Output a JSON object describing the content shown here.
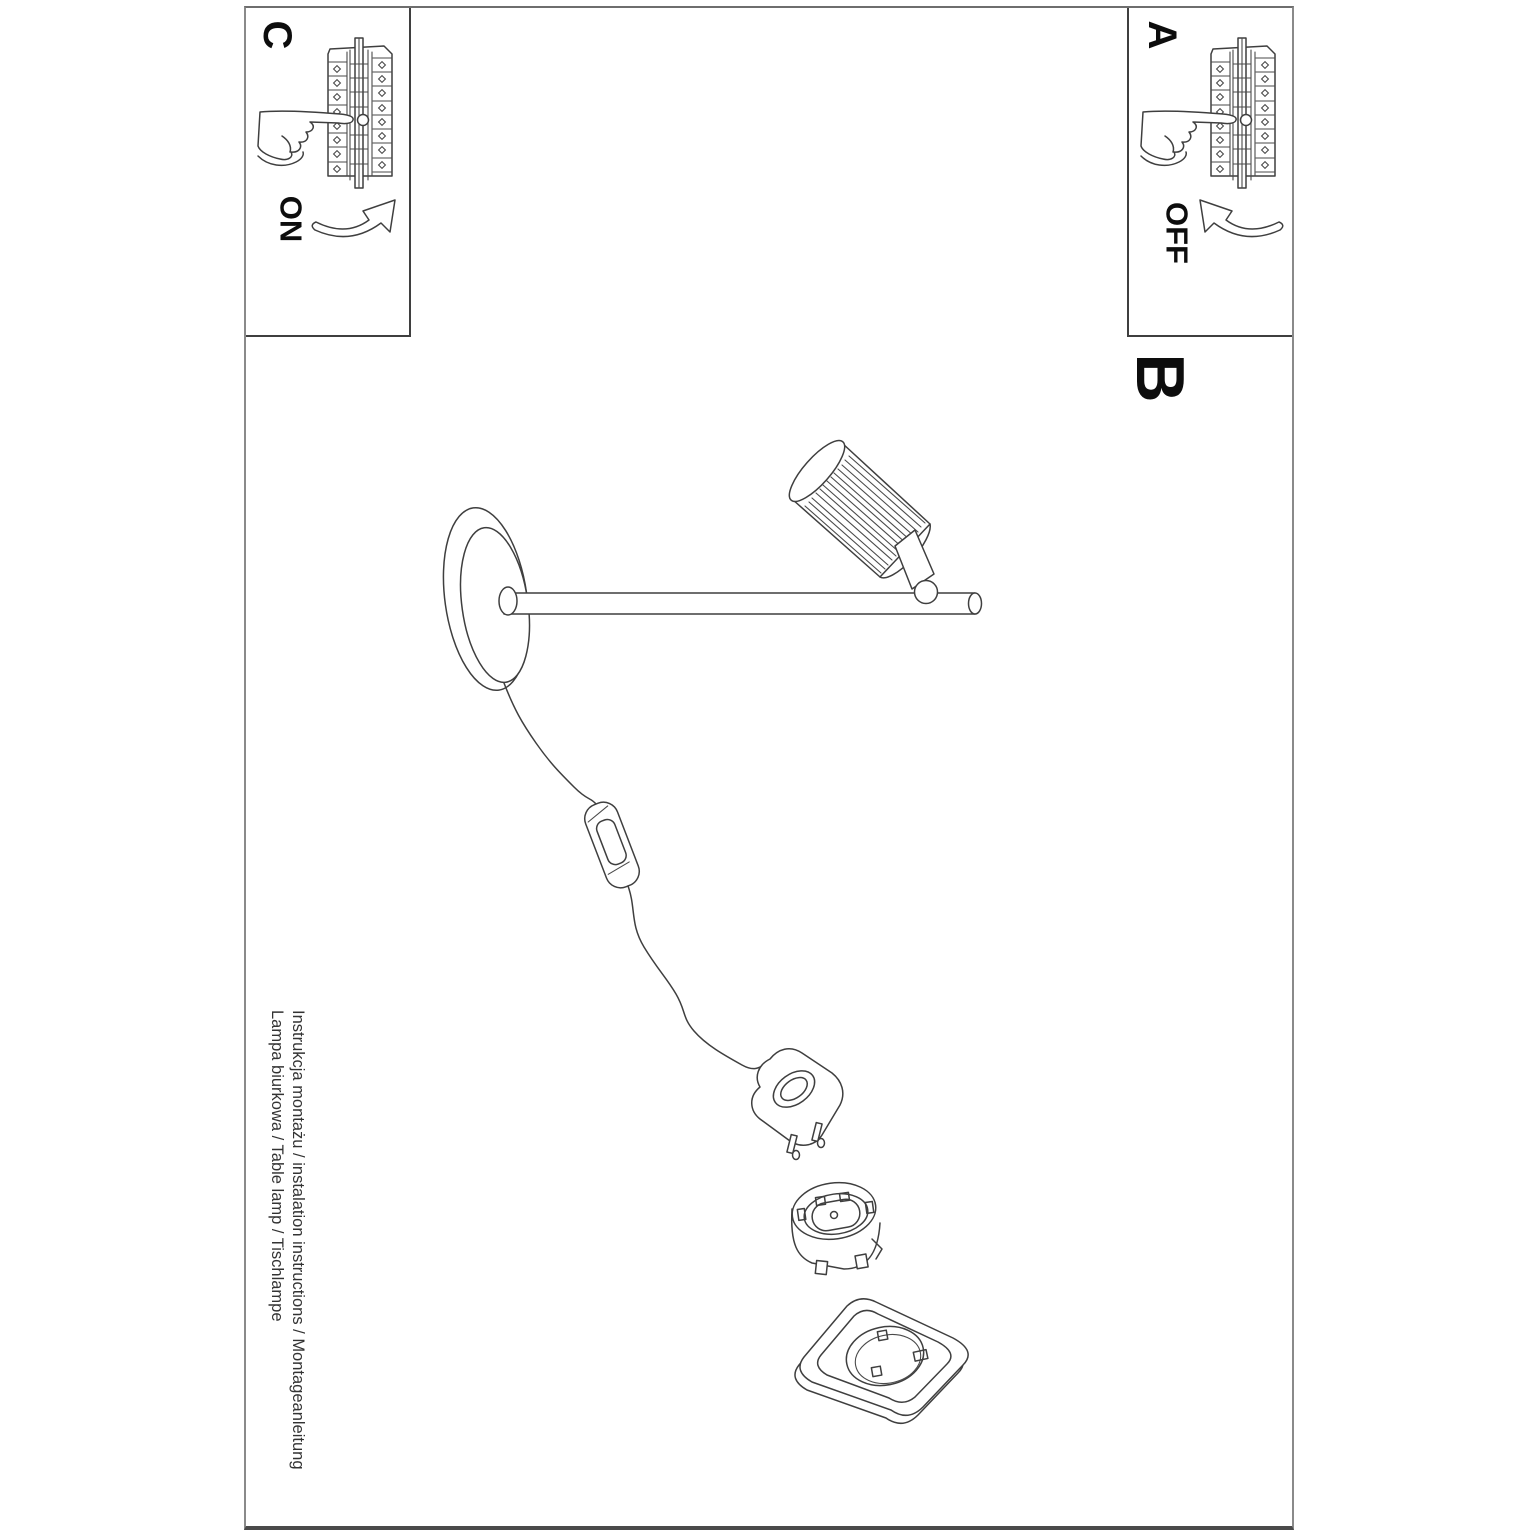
{
  "document": {
    "labels": {
      "step_c": "C",
      "step_a": "A",
      "step_b": "B"
    },
    "switch_words": {
      "on": "ON",
      "off": "OFF"
    },
    "footer": {
      "line1": "Instrukcja montażu / instalation instructions / Montageanleitung",
      "line2": "Lampa biurkowa / Table lamp / Tischlampe"
    },
    "colors": {
      "paper": "#ffffff",
      "ink": "#3f3f3f",
      "page_border": "#8a8a8a",
      "letter": "#0d0d0d"
    },
    "icons": {
      "breaker-panel-icon": "fuse-box line drawing",
      "pointing-hand-icon": "hand pressing breaker lever",
      "curved-arrow-on-icon": "hollow arrow curving up-right",
      "curved-arrow-off-icon": "hollow arrow curving up-left",
      "table-lamp-illustration": "desk lamp with round base, rod arm and ribbed shade",
      "inline-switch-icon": "cord inline rocker switch",
      "euro-plug-icon": "two-pin power plug",
      "socket-insert-icon": "round socket insert",
      "wall-socket-icon": "wall socket plate"
    }
  }
}
